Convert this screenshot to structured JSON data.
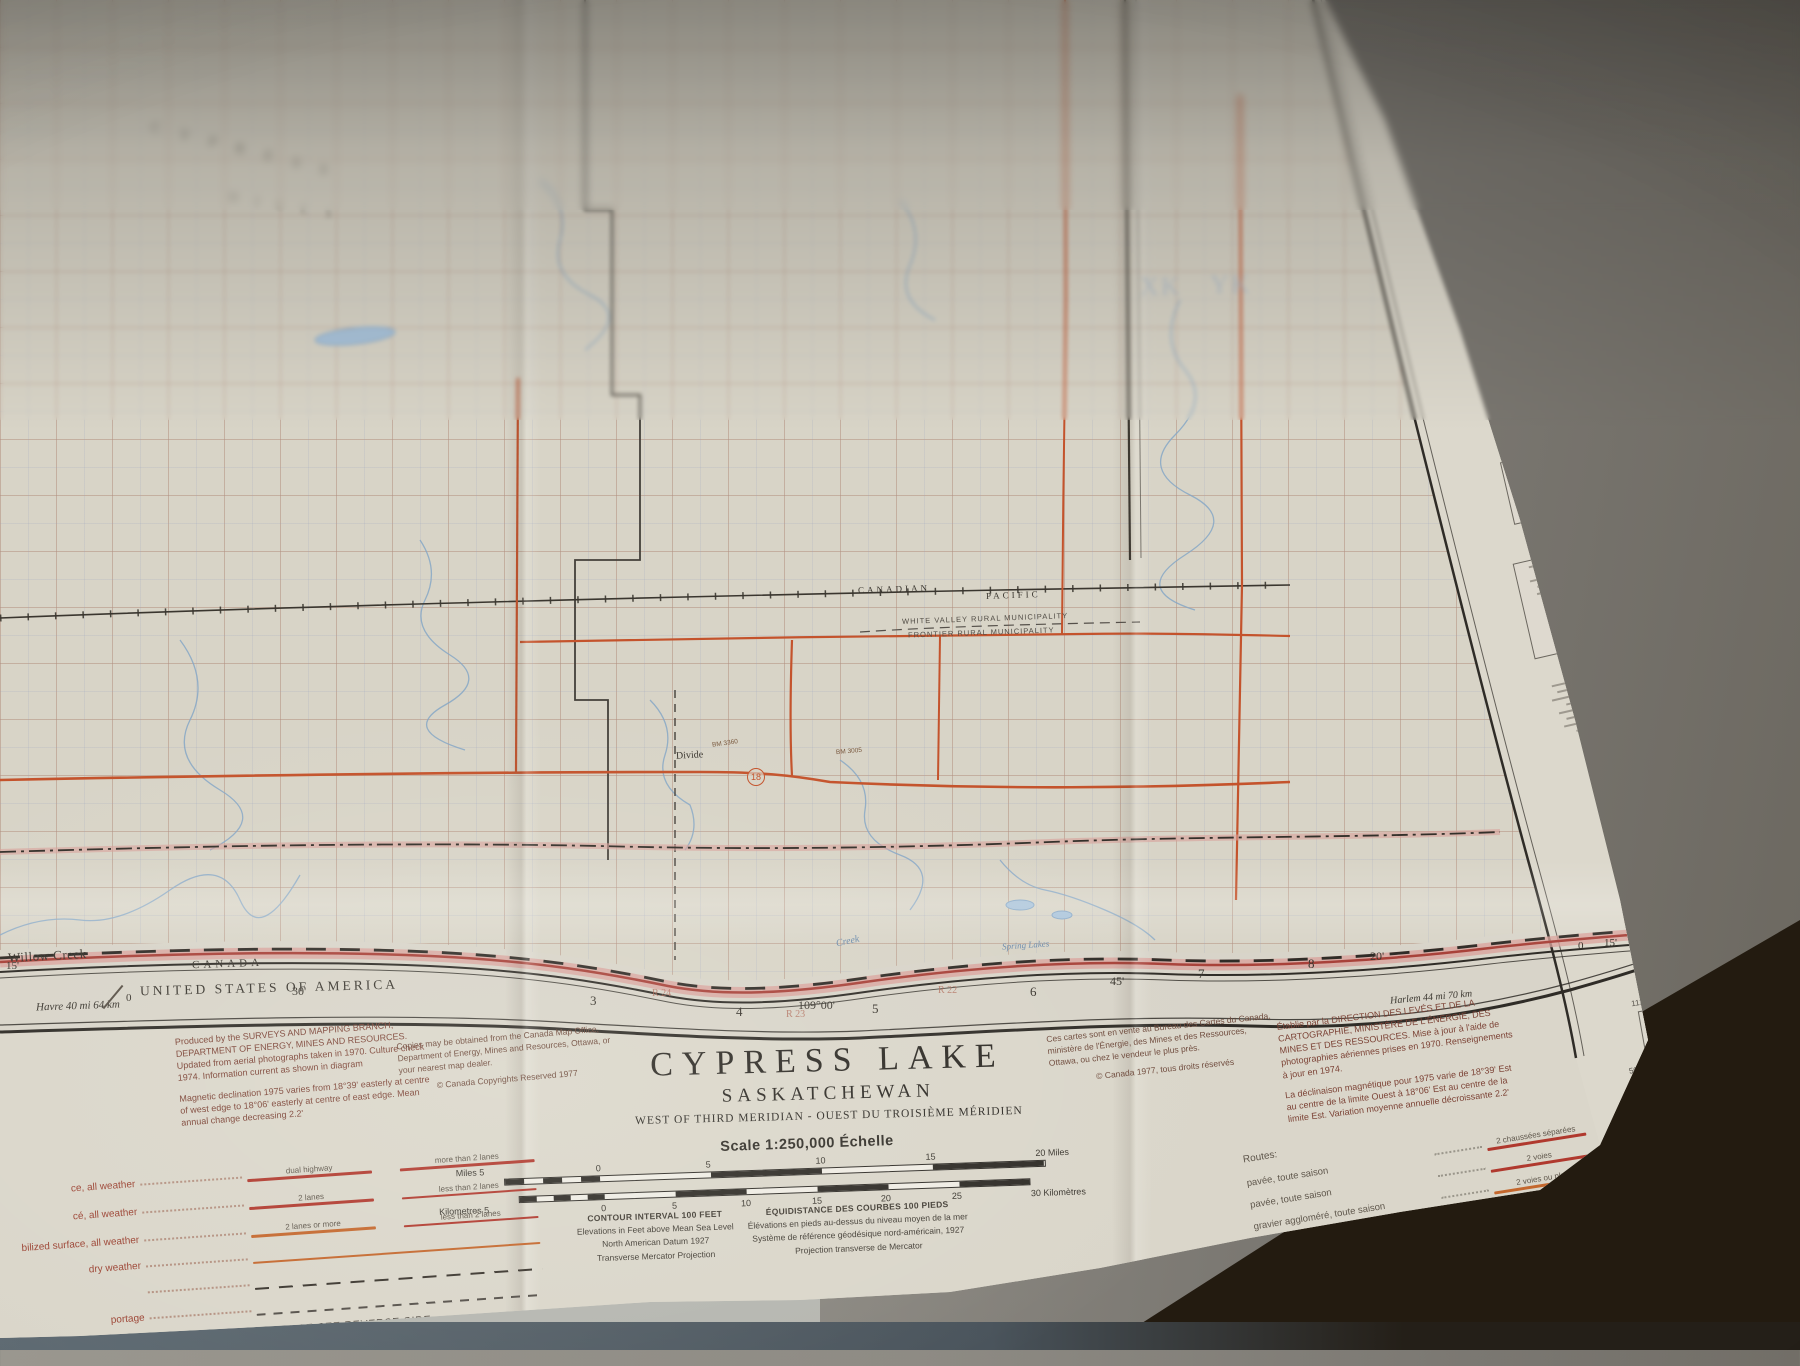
{
  "title_block": {
    "title": "CYPRESS LAKE",
    "subtitle": "SASKATCHEWAN",
    "meridian_line": "WEST OF THIRD MERIDIAN - OUEST DU TROISIÈME MÉRIDIEN"
  },
  "scale_section": {
    "scale_label": "Scale 1:250,000 Échelle",
    "miles_prefix": "Miles 5",
    "miles_ticks": [
      "0",
      "5",
      "10",
      "15",
      "20 Miles"
    ],
    "km_prefix": "Kilometres 5",
    "km_ticks": [
      "0",
      "5",
      "10",
      "15",
      "20",
      "25",
      "30 Kilomètres"
    ],
    "contour_en": {
      "l1": "CONTOUR INTERVAL 100 FEET",
      "l2": "Elevations in Feet above Mean Sea Level",
      "l3": "North American Datum 1927",
      "l4": "Transverse Mercator Projection"
    },
    "contour_fr": {
      "l1": "ÉQUIDISTANCE DES COURBES 100 PIEDS",
      "l2": "Élévations en pieds au-dessus du niveau moyen de la mer",
      "l3": "Système de référence géodésique nord-américain, 1927",
      "l4": "Projection transverse de Mercator"
    }
  },
  "credits": {
    "produced_en": "Produced by the SURVEYS AND MAPPING BRANCH, DEPARTMENT OF ENERGY, MINES AND RESOURCES. Updated from aerial photographs taken in 1970. Culture check 1974. Information current as shown in diagram",
    "magnetic_en": "Magnetic declination 1975 varies from 18°39' easterly at centre of west edge to 18°06' easterly at centre of east edge. Mean annual change decreasing 2.2'",
    "copies_en": "Copies may be obtained from the Canada Map Office, Department of Energy, Mines and Resources, Ottawa, or your nearest map dealer.",
    "copyright_en": "© Canada Copyrights Reserved 1977",
    "copies_fr": "Ces cartes sont en vente au Bureau des Cartes du Canada, ministère de l'Énergie, des Mines et des Ressources, Ottawa, ou chez le vendeur le plus près.",
    "copyright_fr": "© Canada 1977, tous droits réservés",
    "produced_fr": "Établie par la DIRECTION DES LEVÉS ET DE LA CARTOGRAPHIE, MINISTÈRE DE L'ÉNERGIE, DES MINES ET DES RESSOURCES. Mise à jour à l'aide de photographies aériennes prises en 1970. Renseignements à jour en 1974.",
    "magnetic_fr": "La déclinaison magnétique pour 1975 varie de 18°39' Est au centre de la limite Ouest à 18°06' Est au centre de la limite Est. Variation moyenne annuelle décroissante 2.2'"
  },
  "legend_en": {
    "rows": [
      {
        "label": "ce, all weather",
        "bar": "dual highway",
        "right": "more than 2 lanes"
      },
      {
        "label": "cé, all weather",
        "bar": "2 lanes",
        "right": "less than 2 lanes"
      },
      {
        "label": "bilized surface, all weather",
        "bar": "2 lanes or more",
        "right": "less than 2 lanes"
      },
      {
        "label": "dry weather",
        "bar": "",
        "right": ""
      },
      {
        "label": "",
        "bar": "",
        "right": ""
      },
      {
        "label": "portage",
        "bar": "",
        "right": ""
      }
    ],
    "footer": "FOR COMPLETE REFERENCE SEE REVERSE SIDE"
  },
  "legend_fr": {
    "heading": "Routes:",
    "rows": [
      {
        "label": "pavée, toute saison",
        "bar": "2 chaussées séparées",
        "right": "plus de 2 voies"
      },
      {
        "label": "pavée, toute saison",
        "bar": "2 voies",
        "right": "moins de 2 voies"
      },
      {
        "label": "gravier aggloméré, toute saison",
        "bar": "2 voies ou plus",
        "right": "moins de 2 voies"
      },
      {
        "label": "de gravier période sèche",
        "bar": "",
        "right": ""
      },
      {
        "label": "de terre",
        "bar": "",
        "right": ""
      },
      {
        "label": "sentier, percée ou portage",
        "bar": "",
        "right": ""
      }
    ],
    "footer": "POUR UNE LISTE COMPLÈTE DES SIGNES VOIR AU VERSO"
  },
  "neatline": {
    "ticks": [
      {
        "t": "15'"
      },
      {
        "t": "30'"
      },
      {
        "t": "0"
      },
      {
        "t": "3"
      },
      {
        "t": "R 24"
      },
      {
        "t": "4"
      },
      {
        "t": "R 23"
      },
      {
        "t": "109°00'"
      },
      {
        "t": "5"
      },
      {
        "t": "R 22"
      },
      {
        "t": "6"
      },
      {
        "t": "45'"
      },
      {
        "t": "7"
      },
      {
        "t": "8"
      },
      {
        "t": "20'"
      },
      {
        "t": "0"
      },
      {
        "t": "15'"
      },
      {
        "t": "1100000m E"
      }
    ],
    "havre": "Havre 40 mi 64 km",
    "harlem": "Harlem 44 mi 70 km",
    "canada": "CANADA",
    "usa": "UNITED STATES OF AMERICA"
  },
  "map_labels": {
    "willow_creek": "Willow Creek",
    "white_valley": "WHITE VALLEY RURAL MUNICIPALITY",
    "frontier": "FRONTIER RURAL MUNICIPALITY",
    "canadian": "CANADIAN",
    "pacific": "PACIFIC",
    "divide": "Divide",
    "hwy18": "18",
    "bm1": "BM 3360",
    "bm2": "BM 3005",
    "creek": "Creek",
    "spring_lakes": "Spring Lakes",
    "zone_sq1": "XK",
    "zone_sq2": "YK",
    "cypress_spread": "C Y P R E S S",
    "hills_spread": "H I L L S"
  },
  "right_margin": {
    "l1": "TEN THOUSAND METRE",
    "l2": "UNIVERSAL TRANSVERSE MERCATOR GRID",
    "l3": "ZONE 13",
    "l4": "QUADRILLAGE DE DIX MILLE MÈTRES",
    "l5": "PROJECTION TRANSVERSE UNIVERSELLE DE MERCATOR"
  },
  "index_diagram": {
    "lon_left": "112°",
    "lon_right": "110°",
    "lat_top": "50°",
    "lat_bottom": "49°",
    "sheet1": "MEDICINE HAT",
    "sheet2": "FOREMOST"
  },
  "colors": {
    "highway_red": "#b0392e",
    "highway_orange": "#c4672d",
    "grid_orange": "#c47a45",
    "water_blue": "#86a7c6",
    "border_pink": "#d9a099",
    "credit_brown": "#7c4336"
  }
}
